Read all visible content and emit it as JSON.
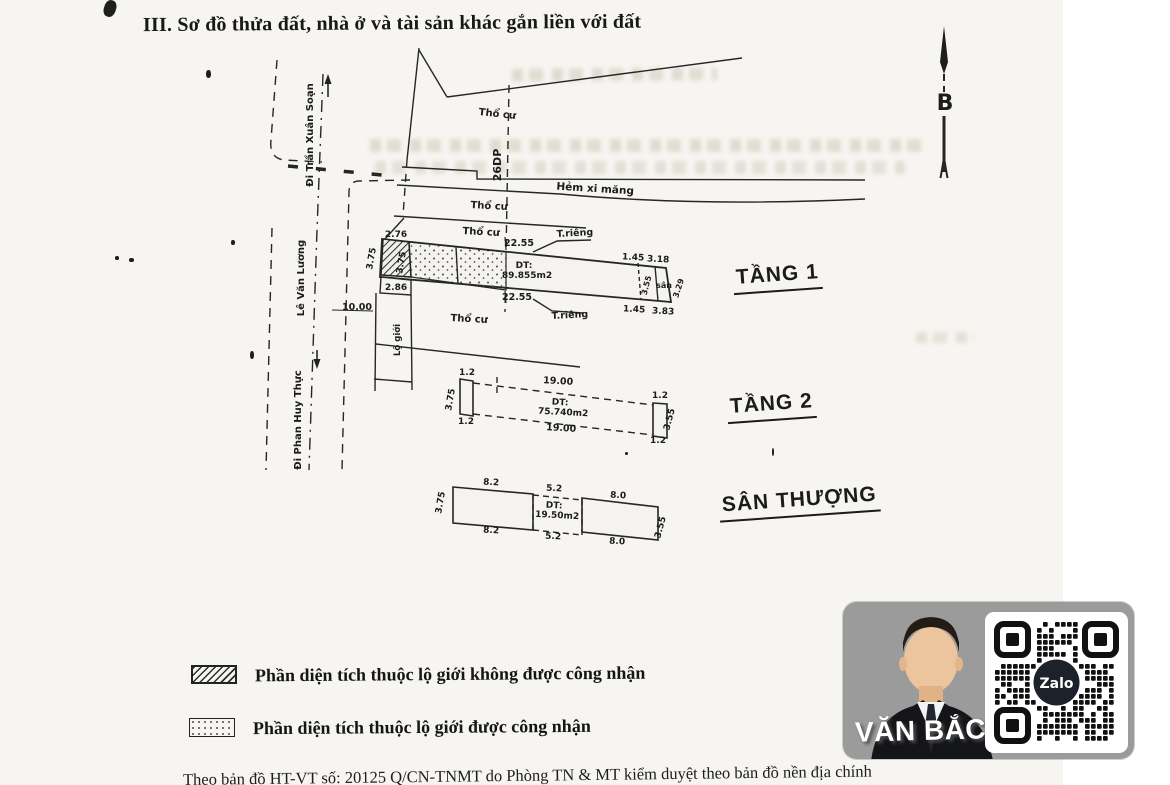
{
  "page": {
    "title": "III. Sơ đồ thửa đất, nhà ở và tài sản khác gắn liền với đất",
    "footer": "Theo bản đồ HT-VT số:  20125 Q/CN-TNMT do Phòng TN & MT kiểm duyệt theo bản đồ nền  địa  chính"
  },
  "compass": {
    "north_label": "B"
  },
  "streets": {
    "di_tran_xuan_soan": "Đi Trần Xuân Soạn",
    "le_van_luong": "Lê Văn Lương",
    "di_phan_huy_thuc": "Đi Phan Huy Thực",
    "lo_gioi": "Lộ giới",
    "boundary_code": "26DP",
    "hem_xi_mang": "Hẻm xi măng"
  },
  "land_labels": {
    "tho_cu": "Thổ cư",
    "t_rieng": "T.riêng",
    "san": "sân",
    "street_width": "10.00"
  },
  "floor1": {
    "name": "TẦNG 1",
    "dt_label": "DT:",
    "dt_value": "89.855m2",
    "top_len": "22.55",
    "bottom_len": "22.55",
    "w_top_left": "2.76",
    "h_left_outer": "3.75",
    "h_left_inner": "3.75",
    "w_bottom_left": "2.86",
    "r_top_a": "1.45",
    "r_top_b": "3.18",
    "r_bottom_a": "1.45",
    "r_bottom_b": "3.83",
    "r_height": "3.55",
    "r_edge": "3.29"
  },
  "floor2": {
    "name": "TẦNG 2",
    "dt_label": "DT:",
    "dt_value": "75.740m2",
    "len_top": "19.00",
    "len_bottom": "19.00",
    "end_seg": "1.2",
    "h_left": "3.75",
    "h_right": "3.55"
  },
  "roof": {
    "name": "SÂN THƯỢNG",
    "dt_label": "DT:",
    "dt_value": "19.50m2",
    "left_top": "8.2",
    "mid_top": "5.2",
    "right_top": "8.0",
    "left_bottom": "8.2",
    "mid_bottom": "5.2",
    "right_bottom": "8.0",
    "h_left": "3.75",
    "h_right": "3.55"
  },
  "legend": {
    "item1": "Phần diện tích thuộc lộ giới không được công nhận",
    "item2": "Phần diện tích thuộc lộ giới được công nhận"
  },
  "watermark": {
    "agent_name": "VĂN BẮC",
    "qr_brand": "Zalo"
  }
}
